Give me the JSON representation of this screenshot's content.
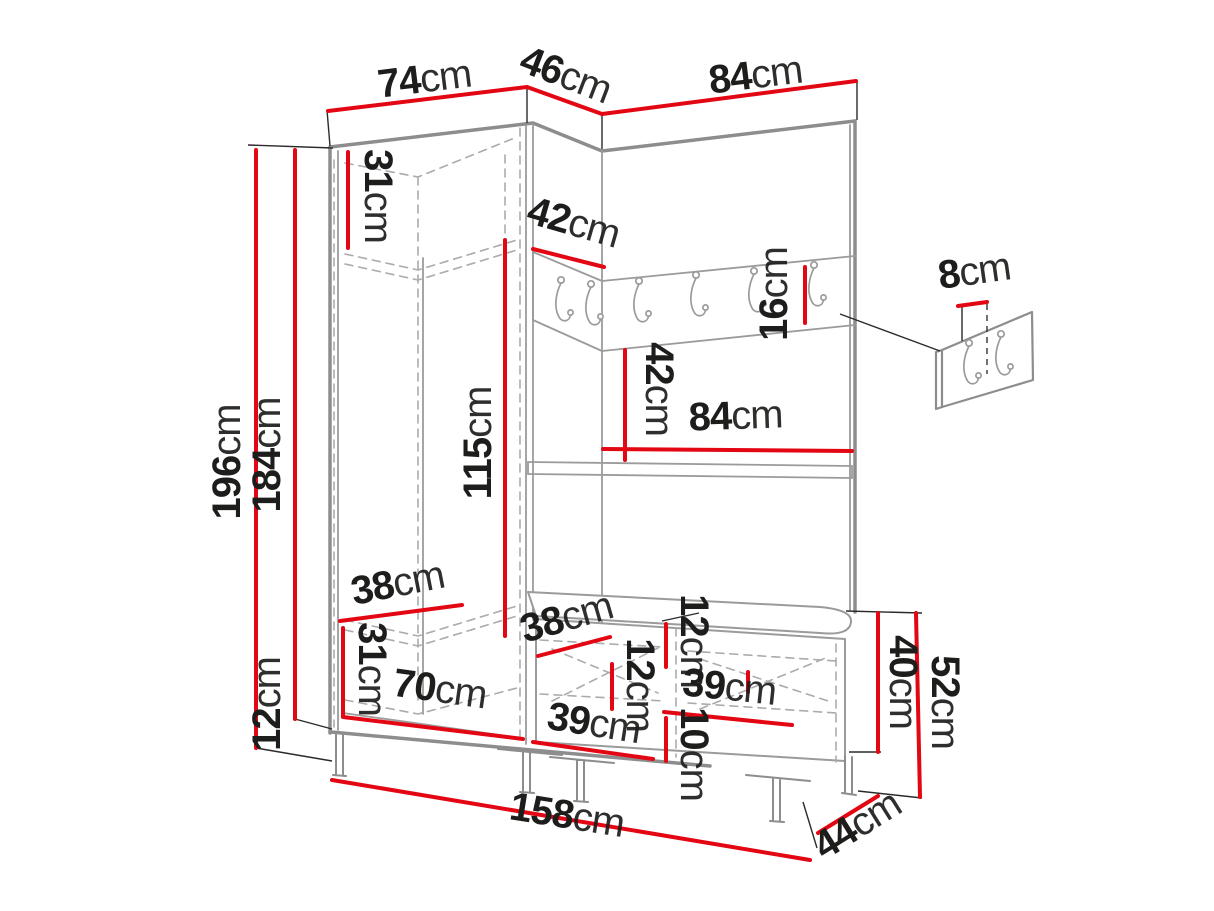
{
  "diagram": {
    "type": "furniture-dimension-drawing",
    "subject": "corner hallway wardrobe set with coat rail, shelf and shoe bench",
    "unit": "cm",
    "colors": {
      "dimension_red": "#e30613",
      "furniture_line": "#9b9b9b",
      "furniture_line_heavy": "#8d8d8d",
      "tick_black": "#2b2b2b",
      "label_text": "#1d1d1b",
      "background": "#ffffff"
    },
    "coat_rail": {
      "hook_count": 6
    },
    "accessory_panel": {
      "hook_count": 2
    },
    "dimensions_summary": {
      "left_wing_width_cm": 74,
      "corner_width_cm": 46,
      "right_wing_width_cm": 84,
      "total_height_cm": 196,
      "carcass_height_cm": 184,
      "leg_height_cm": 12,
      "top_shelf_compartment_cm": 31,
      "corner_rail_width_cm": 42,
      "rail_strip_height_cm": 16,
      "panel_hook_offset_cm": 8,
      "hanging_space_height_cm": 115,
      "rail_to_shelf_cm": 42,
      "shelf_width_cm": 84,
      "wardrobe_shelf_depth_cm": 38,
      "bottom_compartment_height_cm": 31,
      "bench_shelf_depth_cm": 38,
      "bench_top_gap_cm": 12,
      "bench_inner_height_cm": 12,
      "bench_inner_width_cm": 39,
      "bench_bottom_gap_cm": 10,
      "bench_front_width_cm": 39,
      "wardrobe_inner_width_cm": 70,
      "bench_body_height_cm": 40,
      "bench_total_height_cm": 52,
      "total_width_cm": 158,
      "base_depth_cm": 44
    },
    "labels": [
      {
        "id": "left-wing-width",
        "value": "74",
        "x": 426,
        "y": 92,
        "rot": -7
      },
      {
        "id": "corner-width",
        "value": "46",
        "x": 561,
        "y": 87,
        "rot": 21
      },
      {
        "id": "right-wing-width",
        "value": "84",
        "x": 757,
        "y": 88,
        "rot": -7
      },
      {
        "id": "total-height",
        "value": "196",
        "x": 240,
        "y": 462,
        "rot": -90
      },
      {
        "id": "carcass-height",
        "value": "184",
        "x": 280,
        "y": 455,
        "rot": -90
      },
      {
        "id": "leg-height",
        "value": "12",
        "x": 280,
        "y": 704,
        "rot": -90
      },
      {
        "id": "top-shelf-compartment",
        "value": "31",
        "x": 365,
        "y": 196,
        "rot": 90
      },
      {
        "id": "corner-rail-width",
        "value": "42",
        "x": 570,
        "y": 235,
        "rot": 16
      },
      {
        "id": "rail-strip-height",
        "value": "16",
        "x": 787,
        "y": 294,
        "rot": -90
      },
      {
        "id": "panel-hook-offset",
        "value": "8",
        "x": 976,
        "y": 284,
        "rot": -8
      },
      {
        "id": "hanging-space-height",
        "value": "115",
        "x": 491,
        "y": 443,
        "rot": -90
      },
      {
        "id": "rail-to-shelf",
        "value": "42",
        "x": 646,
        "y": 389,
        "rot": 90
      },
      {
        "id": "shelf-width",
        "value": "84",
        "x": 736,
        "y": 429,
        "rot": -2
      },
      {
        "id": "wardrobe-shelf-depth",
        "value": "38",
        "x": 400,
        "y": 596,
        "rot": -11
      },
      {
        "id": "bottom-compartment-height",
        "value": "31",
        "x": 359,
        "y": 669,
        "rot": 90
      },
      {
        "id": "bench-shelf-depth",
        "value": "38",
        "x": 570,
        "y": 630,
        "rot": -16
      },
      {
        "id": "bench-top-gap",
        "value": "12",
        "x": 681,
        "y": 641,
        "rot": 90
      },
      {
        "id": "bench-inner-height",
        "value": "12",
        "x": 627,
        "y": 685,
        "rot": 90
      },
      {
        "id": "bench-inner-width",
        "value": "39",
        "x": 728,
        "y": 700,
        "rot": 6
      },
      {
        "id": "bench-bottom-gap",
        "value": "10",
        "x": 681,
        "y": 754,
        "rot": 90
      },
      {
        "id": "bench-front-width",
        "value": "39",
        "x": 592,
        "y": 736,
        "rot": 9
      },
      {
        "id": "wardrobe-inner-width",
        "value": "70",
        "x": 438,
        "y": 702,
        "rot": 8
      },
      {
        "id": "bench-body-height",
        "value": "40",
        "x": 890,
        "y": 682,
        "rot": 90
      },
      {
        "id": "bench-total-height",
        "value": "52",
        "x": 932,
        "y": 702,
        "rot": 90
      },
      {
        "id": "total-width",
        "value": "158",
        "x": 565,
        "y": 828,
        "rot": 9
      },
      {
        "id": "base-depth",
        "value": "44",
        "x": 864,
        "y": 836,
        "rot": -32
      }
    ]
  }
}
